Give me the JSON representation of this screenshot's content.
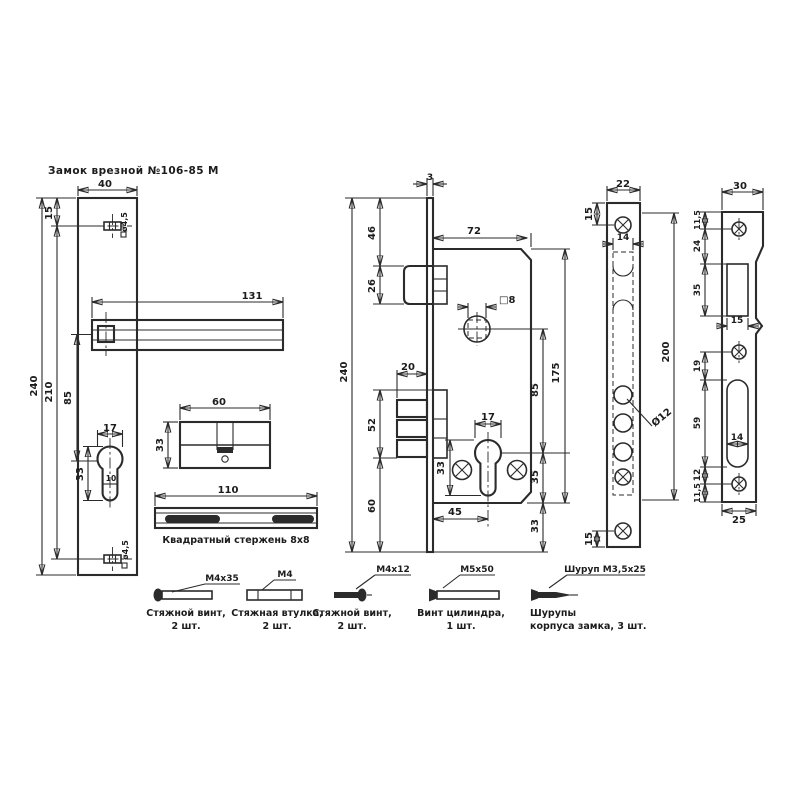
{
  "title": "Замок врезной №106-85 М",
  "handle_plate": {
    "width": "40",
    "height": "240",
    "top_hole_offset": "15",
    "holes_span": "210",
    "handle_to_cylinder": "85",
    "handle_length": "131",
    "top_hole_dia": "ø4,5",
    "bottom_hole_dia": "ø4,5",
    "cylinder_width": "17",
    "cylinder_height": "33",
    "cylinder_narrow": "10"
  },
  "cylinder_view": {
    "length": "60",
    "height": "33"
  },
  "rod_view": {
    "length": "110",
    "caption": "Квадратный стержень 8x8"
  },
  "lock_body": {
    "faceplate_thickness": "3",
    "depth": "72",
    "top_to_latch": "46",
    "latch_height": "26",
    "height": "240",
    "bolt_width": "20",
    "bolt_block_height": "52",
    "bolt_to_bottom": "60",
    "spindle_hole": "□8",
    "cylinder_width": "17",
    "cylinder_height": "33",
    "backset": "45",
    "axis_distance": "85",
    "body_height": "175",
    "cylinder_to_body_bottom": "35",
    "body_bottom_margin": "33"
  },
  "faceplate": {
    "width": "22",
    "length": "200",
    "top_screw_offset": "15",
    "bottom_screw_offset": "15",
    "slot_width": "14",
    "hole_dia": "Ø12"
  },
  "strike_plate": {
    "width_top": "30",
    "width_bottom": "25",
    "top_margin": "11,5",
    "screw_to_latch": "24",
    "latch_opening_height": "35",
    "latch_opening_width": "15",
    "screw_to_slot": "19",
    "slot_height": "59",
    "slot_width": "14",
    "slot_to_screw": "12",
    "bottom_margin": "11,5"
  },
  "hardware": [
    {
      "label": "M4x35",
      "line1": "Стяжной винт,",
      "line2": "2 шт."
    },
    {
      "label": "M4",
      "line1": "Стяжная втулка,",
      "line2": "2 шт."
    },
    {
      "label": "M4x12",
      "line1": "Стяжной винт,",
      "line2": "2 шт."
    },
    {
      "label": "M5x50",
      "line1": "Винт цилиндра,",
      "line2": "1 шт."
    },
    {
      "label": "Шуруп М3,5x25",
      "line1": "Шурупы",
      "line2": "корпуса замка, 3 шт."
    }
  ]
}
